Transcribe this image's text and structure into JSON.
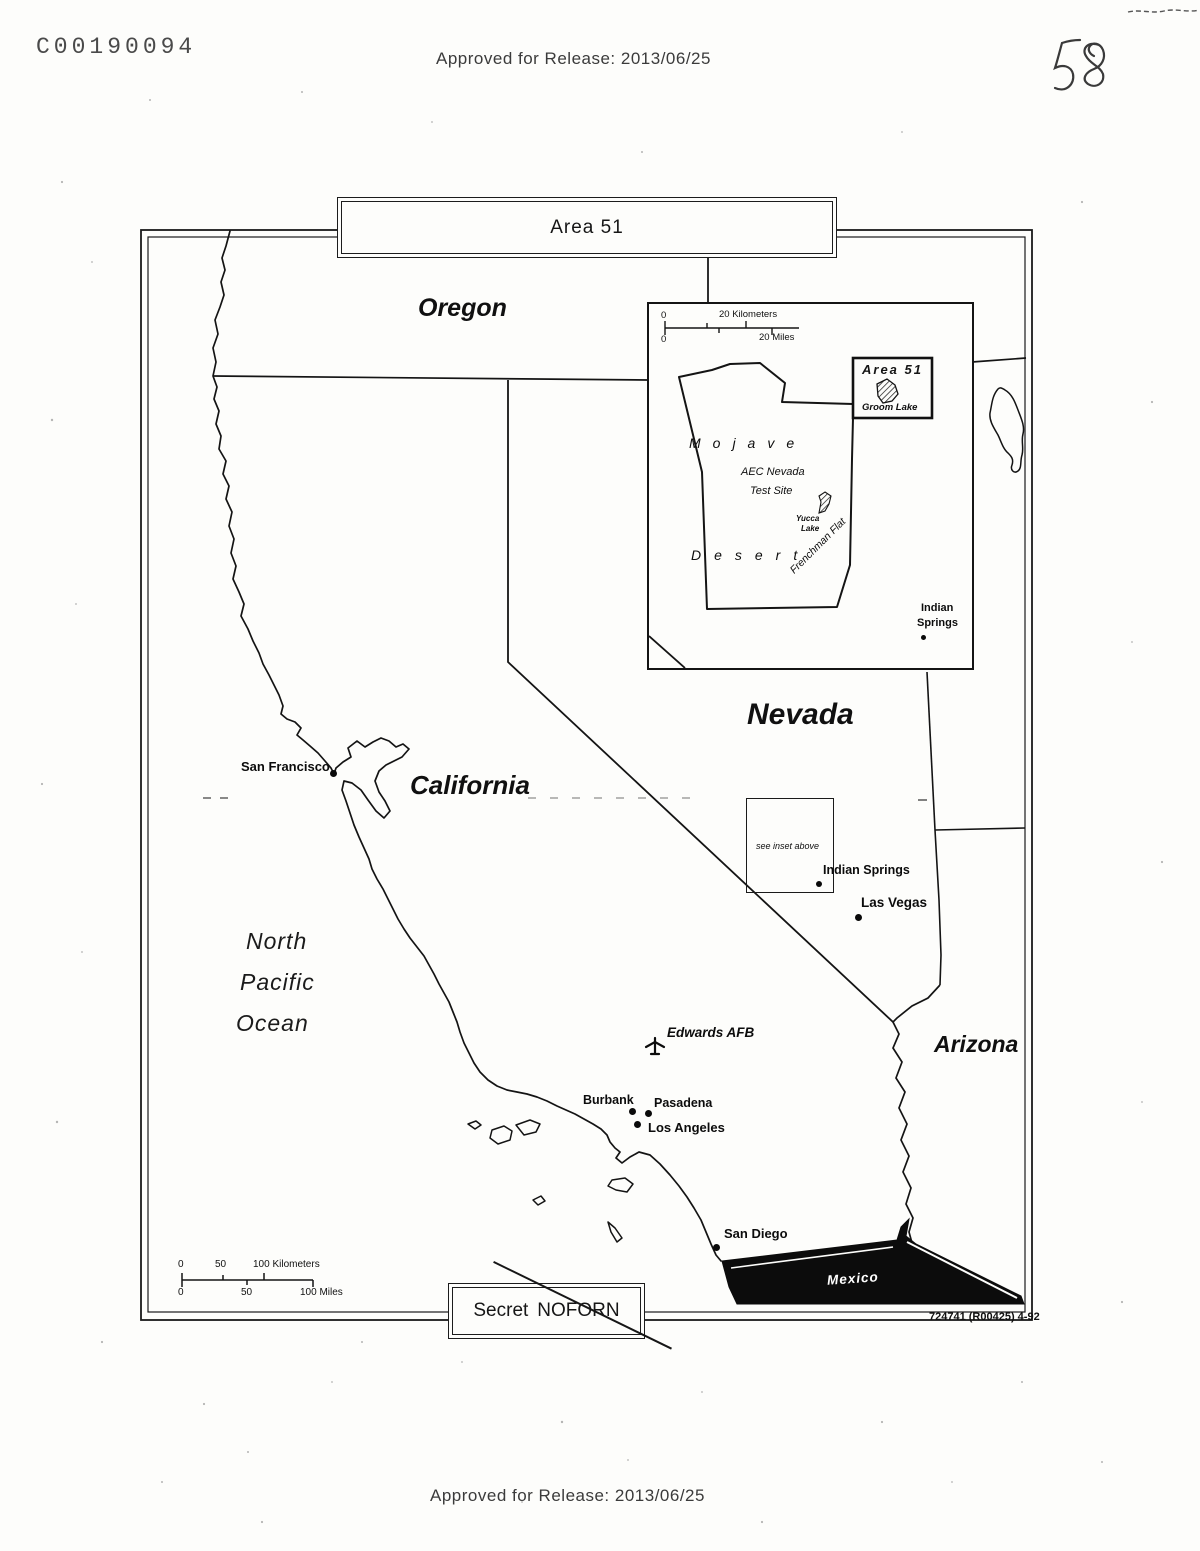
{
  "document": {
    "doc_number": "C00190094",
    "approved_top": "Approved for Release: 2013/06/25",
    "approved_bottom": "Approved for Release: 2013/06/25",
    "page_number_handwritten": "58",
    "figure_ref": "724741 (R00425)  4-92"
  },
  "map": {
    "title": "Area 51",
    "classification": {
      "part1": "Secret",
      "part2": "NOFORN"
    },
    "states": {
      "oregon": "Oregon",
      "california": "California",
      "nevada": "Nevada",
      "arizona": "Arizona"
    },
    "ocean": {
      "line1": "North",
      "line2": "Pacific",
      "line3": "Ocean"
    },
    "country_mexico": "Mexico",
    "cities": {
      "san_francisco": "San Francisco",
      "indian_springs": "Indian Springs",
      "las_vegas": "Las Vegas",
      "burbank": "Burbank",
      "pasadena": "Pasadena",
      "los_angeles": "Los Angeles",
      "san_diego": "San Diego"
    },
    "edwards_afb": "Edwards AFB",
    "inset_note": "see inset above",
    "scale": {
      "km_0": "0",
      "km_50": "50",
      "km_100": "100 Kilometers",
      "mi_0": "0",
      "mi_50": "50",
      "mi_100": "100 Miles"
    }
  },
  "inset": {
    "area51_label": "Area 51",
    "groom_lake": "Groom Lake",
    "mojave": "Mojave",
    "desert": "Desert",
    "aec_line1": "AEC Nevada",
    "aec_line2": "Test Site",
    "yucca_line1": "Yucca",
    "yucca_line2": "Lake",
    "frenchman_flat": "Frenchman Flat",
    "indian_springs_line1": "Indian",
    "indian_springs_line2": "Springs",
    "scale": {
      "km_0": "0",
      "km_20": "20 Kilometers",
      "mi_0": "0",
      "mi_20": "20 Miles"
    }
  }
}
